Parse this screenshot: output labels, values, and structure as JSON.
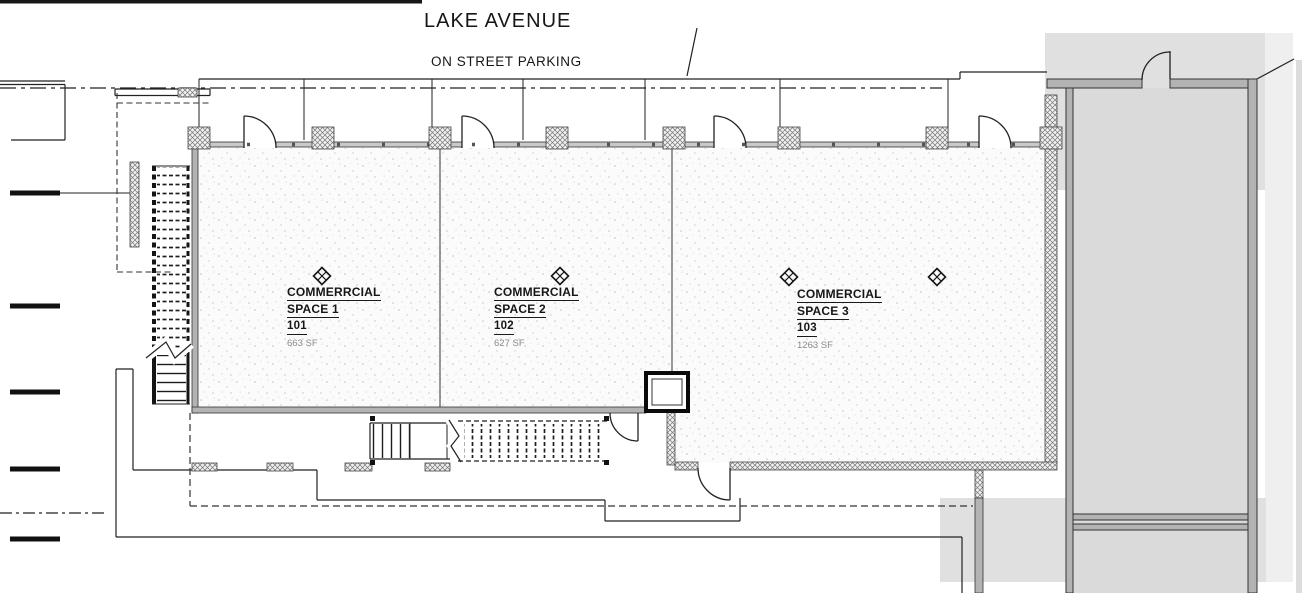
{
  "plan": {
    "street_label": "LAKE AVENUE",
    "parking_label": "ON STREET PARKING",
    "spaces": [
      {
        "title_line1": "COMMERRCIAL",
        "title_line2": "SPACE 1",
        "unit_number": "101",
        "area": "663 SF"
      },
      {
        "title_line1": "COMMERCIAL",
        "title_line2": "SPACE 2",
        "unit_number": "102",
        "area": "627 SF"
      },
      {
        "title_line1": "COMMERCIAL",
        "title_line2": "SPACE 3",
        "unit_number": "103",
        "area": "1263 SF"
      }
    ]
  },
  "icons": {
    "keynote_diamond": "diamond-outline-with-x"
  },
  "colors": {
    "line": "#222222",
    "wall_fill": "#b3b3b3",
    "room_fill": "#dadada",
    "backdrop_fill": "#e0e0e0",
    "floor_background": "#fbfbfb",
    "stipple_dot": "#c4c4c4",
    "text": "#161616",
    "area_text": "#8a8a8a"
  }
}
